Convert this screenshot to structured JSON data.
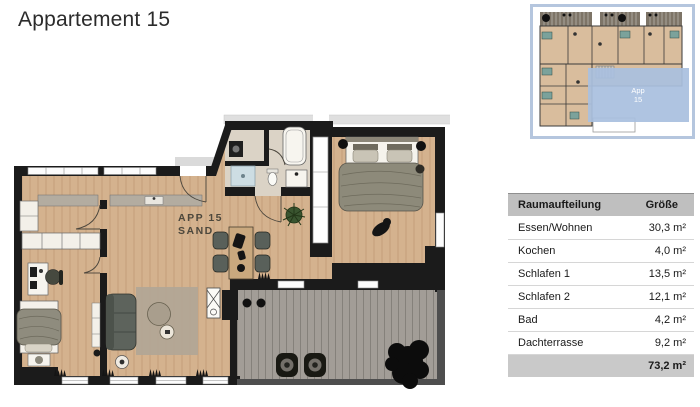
{
  "page": {
    "title": "Appartement 15"
  },
  "floorplan": {
    "label_line1": "APP 15",
    "label_line2": "SAND"
  },
  "thumbnail": {
    "overlay_label_line1": "App",
    "overlay_label_line2": "15"
  },
  "table": {
    "header": {
      "room": "Raumaufteilung",
      "size": "Größe"
    },
    "rows": [
      {
        "name": "Essen/Wohnen",
        "size": "30,3 m²"
      },
      {
        "name": "Kochen",
        "size": "4,0 m²"
      },
      {
        "name": "Schlafen 1",
        "size": "13,5 m²"
      },
      {
        "name": "Schlafen 2",
        "size": "12,1 m²"
      },
      {
        "name": "Bad",
        "size": "4,2 m²"
      },
      {
        "name": "Dachterrasse",
        "size": "9,2 m²"
      }
    ],
    "total": "73,2 m²"
  },
  "colors": {
    "floor_sand": "#d4b28e",
    "wall": "#1b1b1b",
    "terrace": "#a29d97",
    "bath_floor": "#dbd3c6",
    "accent_blue": "#a9c0df",
    "table_header_bg": "#bfbfbf",
    "table_total_bg": "#c9c9c9"
  }
}
